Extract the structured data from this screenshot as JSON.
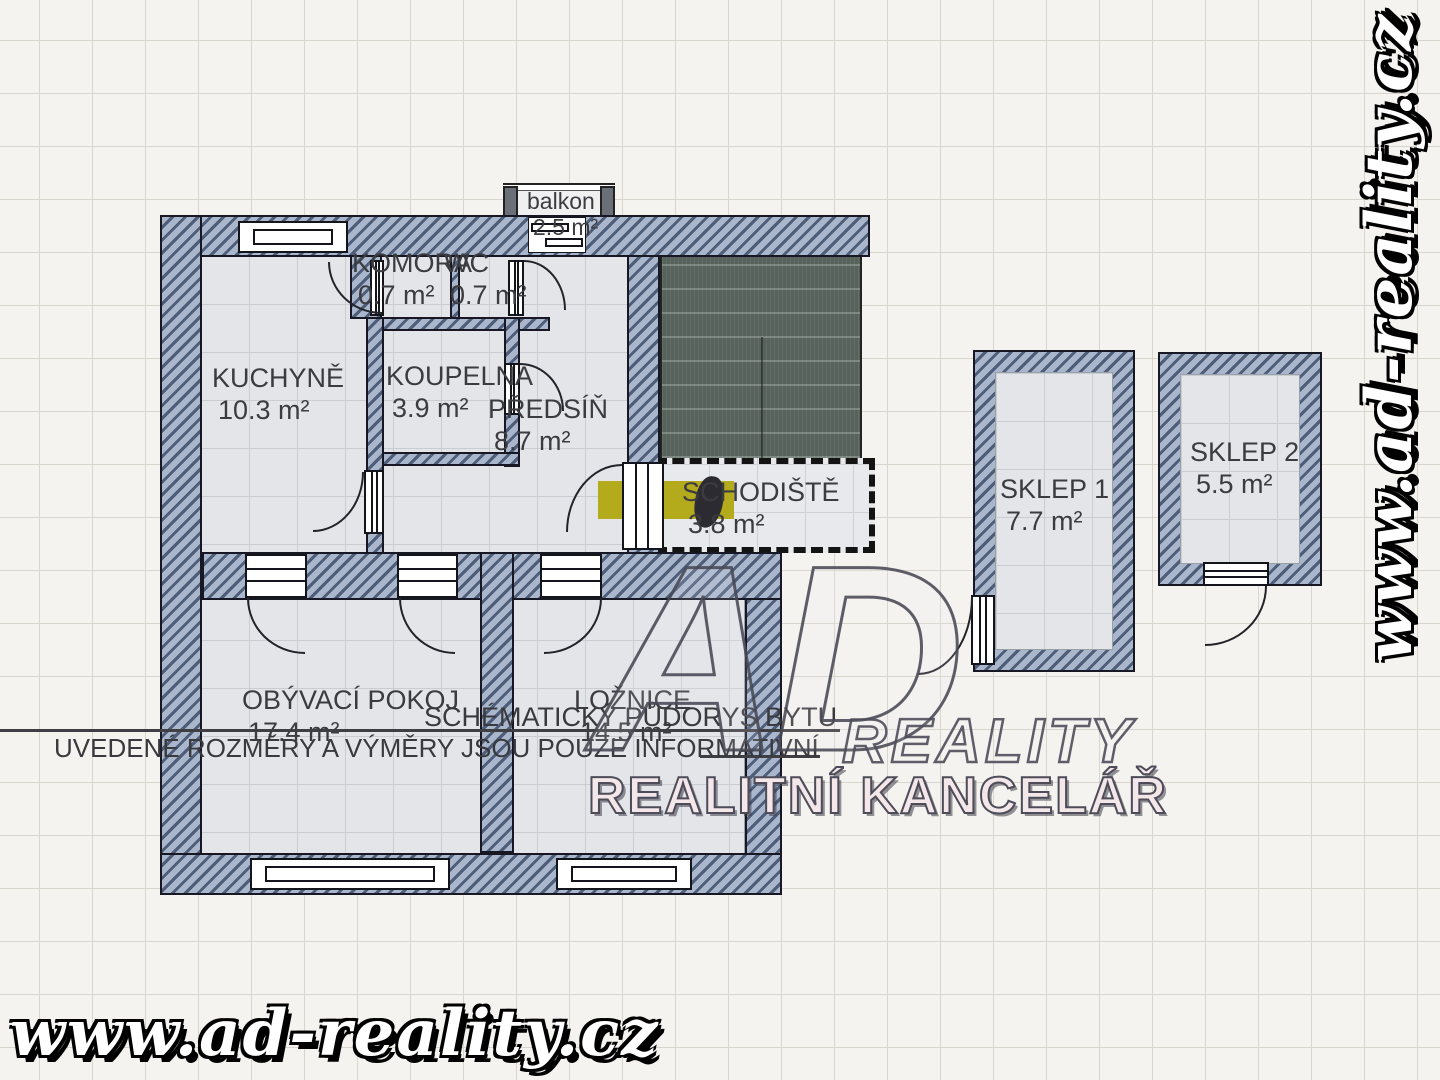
{
  "plan": {
    "title": "SCHÉMATICKÝ PŮDORYS BYTU",
    "disclaimer": "UVEDENÉ ROZMĚRY A VÝMĚRY JSOU POUZE INFORMATIVNÍ"
  },
  "rooms": {
    "balkon": {
      "name": "balkon",
      "area": "2.5 m²"
    },
    "komora": {
      "name": "KOMORA",
      "area": "0.7 m²"
    },
    "wc": {
      "name": "WC",
      "area": "0.7 m²"
    },
    "kuchyne": {
      "name": "KUCHYNĚ",
      "area": "10.3 m²"
    },
    "koupelna": {
      "name": "KOUPELNA",
      "area": "3.9 m²"
    },
    "predsin": {
      "name": "PŘEDSÍŇ",
      "area": "8.7 m²"
    },
    "schodiste": {
      "name": "SCHODIŠTĚ",
      "area": "3.8 m²"
    },
    "obyvaci_pokoj": {
      "name": "OBÝVACÍ POKOJ",
      "area": "17.4 m²"
    },
    "loznice": {
      "name": "LOŽNICE",
      "area": "14.5 m²"
    },
    "sklep1": {
      "name": "SKLEP 1",
      "area": "7.7 m²"
    },
    "sklep2": {
      "name": "SKLEP 2",
      "area": "5.5 m²"
    }
  },
  "watermarks": {
    "website": "www.ad-reality.cz",
    "logo_initials": "AD",
    "logo_name": "REALITY",
    "logo_tagline": "REALITNÍ KANCELÁŘ"
  },
  "colors": {
    "wall_light": "#a9b6cc",
    "wall_dark": "#4e5e79",
    "floor": "#e3e5e8",
    "background": "#f5f3ef",
    "stairwell": "#57625c",
    "entry_highlight": "#b3aa1c"
  }
}
